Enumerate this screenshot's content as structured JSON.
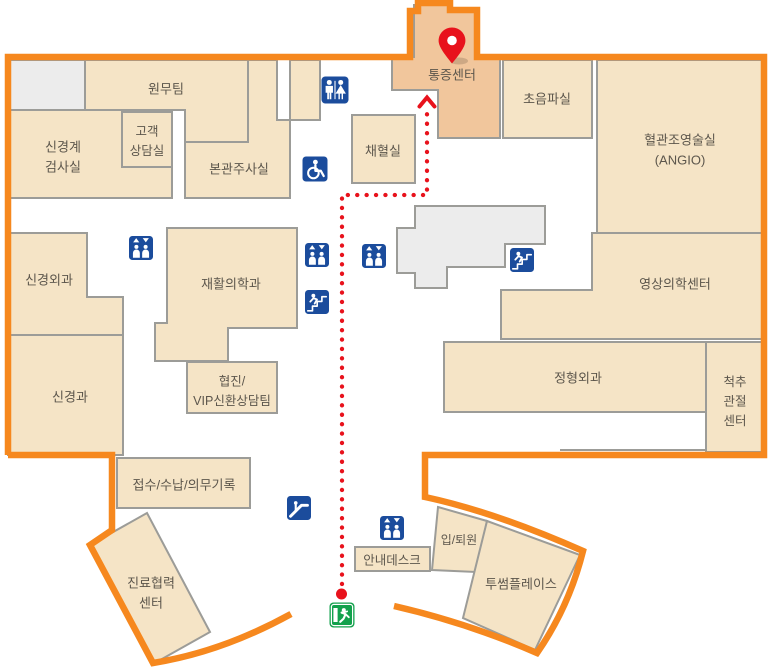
{
  "map": {
    "title": "hospital-floor-guide-map",
    "colors": {
      "boundary": "#f6881e",
      "room_fill": "#f5e4c6",
      "highlight_fill": "#f1c69c",
      "grey_fill": "#ececec",
      "room_stroke": "#9c9c98",
      "icon_blue": "#1b4c9c",
      "exit_green": "#12a14c",
      "route_red": "#e8121c",
      "label_color": "#5c564c"
    },
    "rooms": [
      {
        "id": "grey-room-topleft",
        "label": "",
        "fill": "grey",
        "points": "8,60 85,60 85,110 8,110",
        "label_x": 0,
        "label_y": 0
      },
      {
        "id": "admin-team",
        "label": "원무팀",
        "fill": "beige",
        "points": "85,60 248,60 248,142 185,142 185,110 85,110",
        "label_x": 166,
        "label_y": 89
      },
      {
        "id": "main-injection-room",
        "label": "본관주사실",
        "fill": "beige",
        "points": "248,60 277,60 277,120 290,120 290,198 185,198 185,142 248,142",
        "label_x": 239,
        "label_y": 169
      },
      {
        "id": "small-room-top",
        "label": "",
        "fill": "beige",
        "points": "290,60 320,60 320,120 290,120",
        "label_x": 0,
        "label_y": 0
      },
      {
        "id": "neuro-exam-room",
        "label": "신경계\n검사실",
        "fill": "beige",
        "points": "8,110 172,110 172,198 8,198",
        "label_x": 63,
        "label_y": 157
      },
      {
        "id": "customer-consult-room",
        "label": "고객\n상담실",
        "fill": "beige",
        "points": "122,112 172,112 172,167 122,167",
        "label_x": 147,
        "label_y": 141,
        "fs": 12.5
      },
      {
        "id": "blood-collection-room",
        "label": "채혈실",
        "fill": "beige",
        "points": "352,115 415,115 415,183 352,183",
        "label_x": 383,
        "label_y": 151
      },
      {
        "id": "pain-center",
        "label": "통증센터",
        "fill": "highlight",
        "points": "414,5 450,5 450,11 477,11 477,57 500,57 500,138 438,138 438,90 392,90 392,57 414,57",
        "label_x": 452,
        "label_y": 75
      },
      {
        "id": "ultrasound-room",
        "label": "초음파실",
        "fill": "beige",
        "points": "503,60 592,60 592,138 503,138",
        "label_x": 547,
        "label_y": 99
      },
      {
        "id": "angio-room",
        "label": "혈관조영술실\n(ANGIO)",
        "fill": "beige",
        "points": "597,60 762,60 762,233 597,233",
        "label_x": 680,
        "label_y": 150
      },
      {
        "id": "grey-area-center",
        "label": "",
        "fill": "grey",
        "points": "415,206 545,206 545,244 505,244 505,267 447,267 447,288 415,288 415,273 397,273 397,228 415,228",
        "label_x": 0,
        "label_y": 0
      },
      {
        "id": "imaging-center",
        "label": "영상의학센터",
        "fill": "beige",
        "points": "592,233 762,233 762,339 501,339 501,290 592,290",
        "label_x": 675,
        "label_y": 284
      },
      {
        "id": "orthopedics",
        "label": "정형외과",
        "fill": "beige",
        "points": "444,342 706,342 706,412 444,412",
        "label_x": 578,
        "label_y": 378
      },
      {
        "id": "spine-joint-center",
        "label": "척추\n관절\n센터",
        "fill": "beige",
        "points": "706,342 762,342 762,452 706,452",
        "label_x": 735,
        "label_y": 401,
        "fs": 12.5
      },
      {
        "id": "neurosurgery",
        "label": "신경외과",
        "fill": "beige",
        "points": "8,233 87,233 87,297 123,297 123,335 8,335",
        "label_x": 49,
        "label_y": 280
      },
      {
        "id": "neurology",
        "label": "신경과",
        "fill": "beige",
        "points": "8,335 123,335 123,455 8,455",
        "label_x": 70,
        "label_y": 397
      },
      {
        "id": "rehabilitation-medicine",
        "label": "재활의학과",
        "fill": "beige",
        "points": "167,228 297,228 297,328 228,328 228,361 155,361 155,323 167,323",
        "label_x": 231,
        "label_y": 284
      },
      {
        "id": "cooperation-vip-team",
        "label": "협진/\nVIP신환상담팀",
        "fill": "beige",
        "points": "187,362 277,362 277,413 187,413",
        "label_x": 232,
        "label_y": 391,
        "fs": 12.5
      },
      {
        "id": "reception-payment-records",
        "label": "접수/수납/의무기록",
        "fill": "beige",
        "points": "117,458 250,458 250,508 117,508",
        "label_x": 184,
        "label_y": 485
      },
      {
        "id": "care-cooperation-center",
        "label": "진료협력\n센터",
        "fill": "beige",
        "points": "90,545 147,513 210,632 153,664",
        "label_x": 151,
        "label_y": 593
      },
      {
        "id": "info-desk",
        "label": "안내데스크",
        "fill": "beige",
        "points": "355,547 430,547 430,571 355,571",
        "label_x": 392,
        "label_y": 560,
        "fs": 12.5
      },
      {
        "id": "admission-discharge",
        "label": "입/퇴원",
        "fill": "beige",
        "points": "438,507 487,521 476,572 432,570",
        "label_x": 459,
        "label_y": 540,
        "fs": 12
      },
      {
        "id": "twosome-place",
        "label": "투썸플레이스",
        "fill": "beige",
        "points": "487,521 580,555 535,650 463,618",
        "label_x": 521,
        "label_y": 584
      }
    ],
    "walls": [
      {
        "x1": 560,
        "y1": 450,
        "x2": 706,
        "y2": 450
      }
    ],
    "icons": [
      {
        "name": "restroom-icon",
        "type": "restroom",
        "x": 335,
        "y": 90,
        "s": 27
      },
      {
        "name": "wheelchair-icon",
        "type": "wheelchair",
        "x": 315,
        "y": 169,
        "s": 25
      },
      {
        "name": "elevator-icon-1",
        "type": "elevator",
        "x": 141,
        "y": 248,
        "s": 24
      },
      {
        "name": "elevator-icon-2",
        "type": "elevator",
        "x": 317,
        "y": 255,
        "s": 24
      },
      {
        "name": "elevator-icon-3",
        "type": "elevator",
        "x": 374,
        "y": 256,
        "s": 24
      },
      {
        "name": "stairs-icon-1",
        "type": "stairs",
        "x": 317,
        "y": 302,
        "s": 24
      },
      {
        "name": "stairs-icon-2",
        "type": "stairs",
        "x": 522,
        "y": 260,
        "s": 24
      },
      {
        "name": "escalator-icon",
        "type": "escalator",
        "x": 299,
        "y": 508,
        "s": 24
      },
      {
        "name": "elevator-icon-4",
        "type": "elevator",
        "x": 392,
        "y": 528,
        "s": 24
      },
      {
        "name": "exit-icon",
        "type": "exit",
        "x": 342,
        "y": 615,
        "s": 25
      }
    ],
    "route": {
      "points": [
        [
          342,
          584
        ],
        [
          342,
          195
        ],
        [
          427,
          195
        ],
        [
          427,
          107
        ]
      ],
      "start_dot": [
        341.5,
        594
      ],
      "arrow": "M 419.5,106.5 L 427,97.5 L 434.5,106.5"
    },
    "pin": {
      "x": 452,
      "y": 40.5,
      "target": "통증센터"
    }
  }
}
